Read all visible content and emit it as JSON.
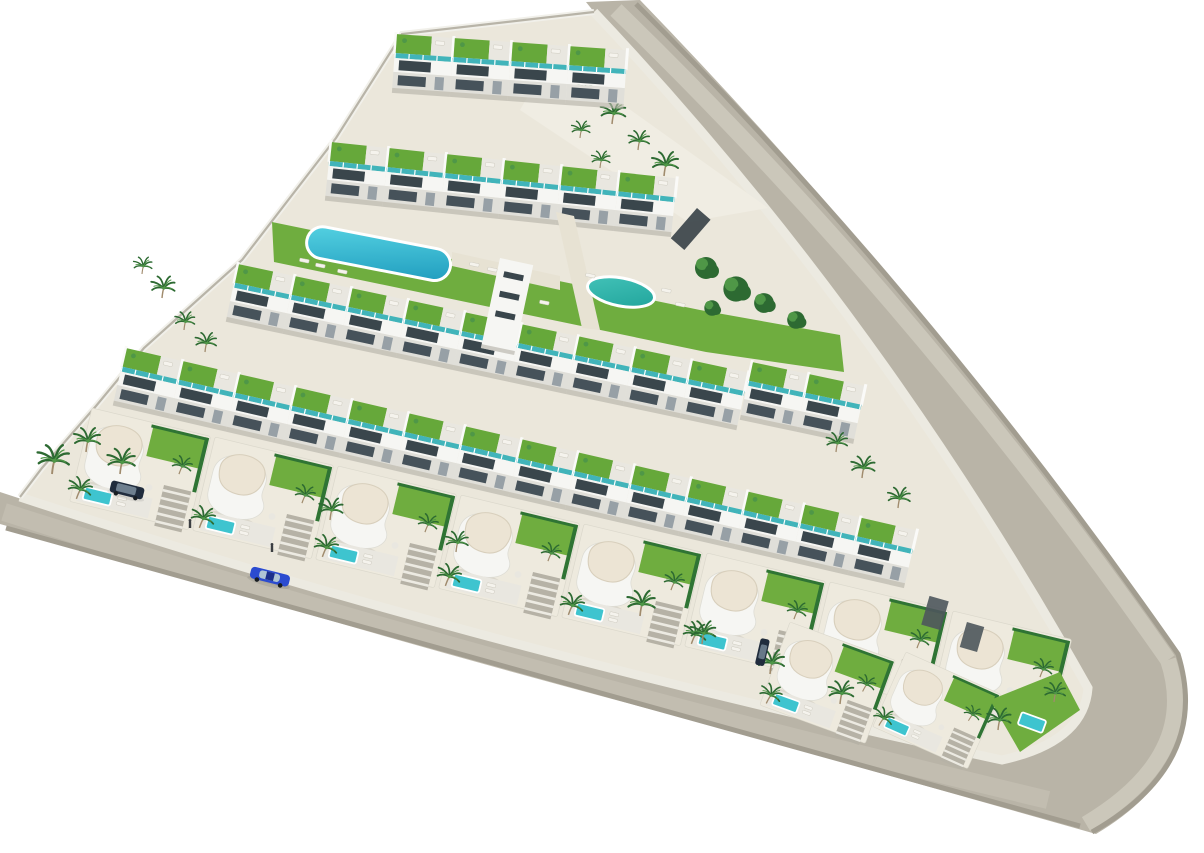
{
  "scene": {
    "description": "Aerial 3D architect render of a triangular residential development: rows of white apartment blocks with rooftop lawn terraces and teal glass balconies, a communal garden with an oval lap pool and a round pool, a front row of curved white villas with cream sculpted roofs and private plunge pools, palm trees, and a beige perimeter road along the right and bottom edges with a rounded corner.",
    "background": "#ffffff"
  },
  "palette": {
    "road": "#b9b4a7",
    "road-light": "#cbc7ba",
    "road-mid": "#c2bdb0",
    "road-dark": "#a29d90",
    "sidewalk": "#eceae1",
    "sand": "#ebe7db",
    "plaza": "#f0ede3",
    "wall-white": "#f6f6f3",
    "wall-shade": "#e0dfd9",
    "window-dark": "#3a464c",
    "glass-teal": "#41b4ba",
    "roof-lawn": "#66a83a",
    "lawn": "#6fad3f",
    "pool-light": "#55d2e2",
    "pool-deep": "#1f9cbe",
    "pool-round-light": "#45c4ba",
    "pool-round-deep": "#1fa39a",
    "pool-villa": "#3ec4cf",
    "roof-cream": "#ece4d4",
    "roof-cream-edge": "#d8cfbc",
    "palm-dark": "#2d6a32",
    "palm-mid": "#4f9747",
    "trunk": "#a08b6d",
    "hedge": "#2f7434",
    "car-blue": "#2b4bd0",
    "car-blue-dark": "#1c2f8a",
    "car-dark": "#202c3d"
  },
  "objects": {
    "communal_pools": [
      {
        "name": "oval-lap-pool",
        "shape": "stadium",
        "location": "upper-central garden"
      },
      {
        "name": "round-pool",
        "shape": "circle",
        "location": "central garden, right"
      }
    ],
    "apartment_rows": 5,
    "front_villas": 8,
    "corner_villas": 2,
    "cars": [
      {
        "name": "blue-sedan",
        "location": "bottom road",
        "color": "#2b4bd0"
      },
      {
        "name": "dark-suv",
        "location": "left corner driveway",
        "color": "#202c3d"
      },
      {
        "name": "dark-car",
        "location": "villa driveway right of center",
        "color": "#202c3d"
      }
    ],
    "pedestrians": 2
  }
}
